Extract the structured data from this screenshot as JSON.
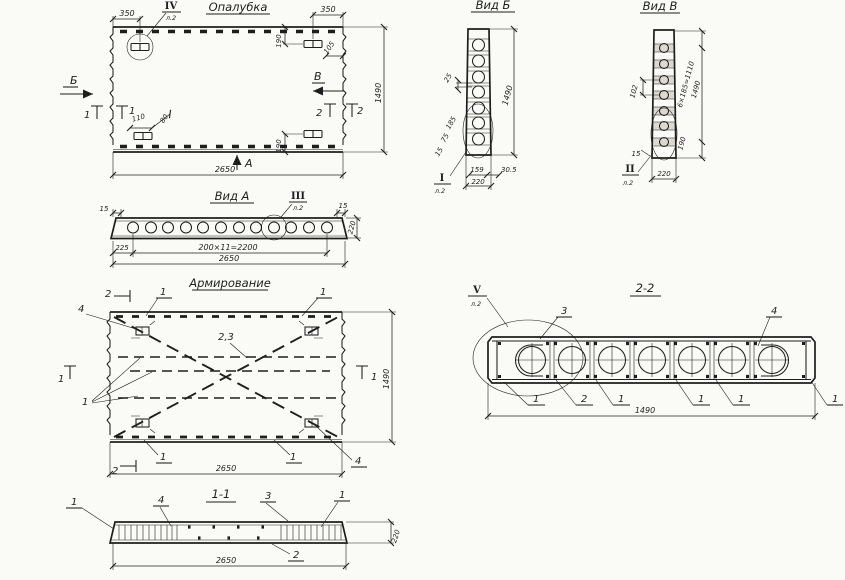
{
  "palette": {
    "paper": "#fafaf6",
    "ink": "#1e1e1e"
  },
  "formwork": {
    "title": "Опалубка",
    "detail": {
      "numeral": "IV",
      "sheet": "л.2"
    },
    "arrow_left": "Б",
    "arrow_right": "В",
    "arrow_bottom": "А",
    "section_left": "1",
    "section_right": "2",
    "dims": {
      "offset_left": "350",
      "offset_right": "350",
      "anchor_top": "190",
      "anchor_bottom": "190",
      "edge": "105",
      "anchor_w": "110",
      "anchor_h": "80",
      "width": "2650",
      "height": "1490"
    }
  },
  "view_a": {
    "title": "Вид А",
    "detail": {
      "numeral": "III",
      "sheet": "л.2"
    },
    "dims": {
      "chamfer_l": "15",
      "chamfer_r": "15",
      "first": "225",
      "pitch": "200×11=2200",
      "width": "2650",
      "height": "220"
    }
  },
  "view_b": {
    "title": "Вид Б",
    "detail": {
      "numeral": "I",
      "sheet": "л.2"
    },
    "dims": {
      "web": "25",
      "height": "1490",
      "d185": "185",
      "d75": "75",
      "d15": "15",
      "hole": "159",
      "rim": "30.5",
      "width": "220"
    }
  },
  "view_v": {
    "title": "Вид В",
    "detail": {
      "numeral": "II",
      "sheet": "л.2"
    },
    "dims": {
      "d102": "102",
      "pitch": "6×185=1110",
      "height": "1490",
      "end": "190",
      "d15": "15",
      "width": "220"
    }
  },
  "reinforcement": {
    "title": "Армирование",
    "pos1": "1",
    "pos23": "2,3",
    "pos4": "4",
    "section2": "2",
    "section1": "1",
    "dims": {
      "width": "2650",
      "height": "1490"
    }
  },
  "section22": {
    "title": "2-2",
    "detail": {
      "numeral": "V",
      "sheet": "л.2"
    },
    "pos1": "1",
    "pos2": "2",
    "pos3": "3",
    "pos4": "4",
    "dims": {
      "length": "1490"
    }
  },
  "section11": {
    "title": "1-1",
    "pos1": "1",
    "pos2": "2",
    "pos3": "3",
    "pos4": "4",
    "dims": {
      "length": "2650",
      "height": "220"
    }
  }
}
